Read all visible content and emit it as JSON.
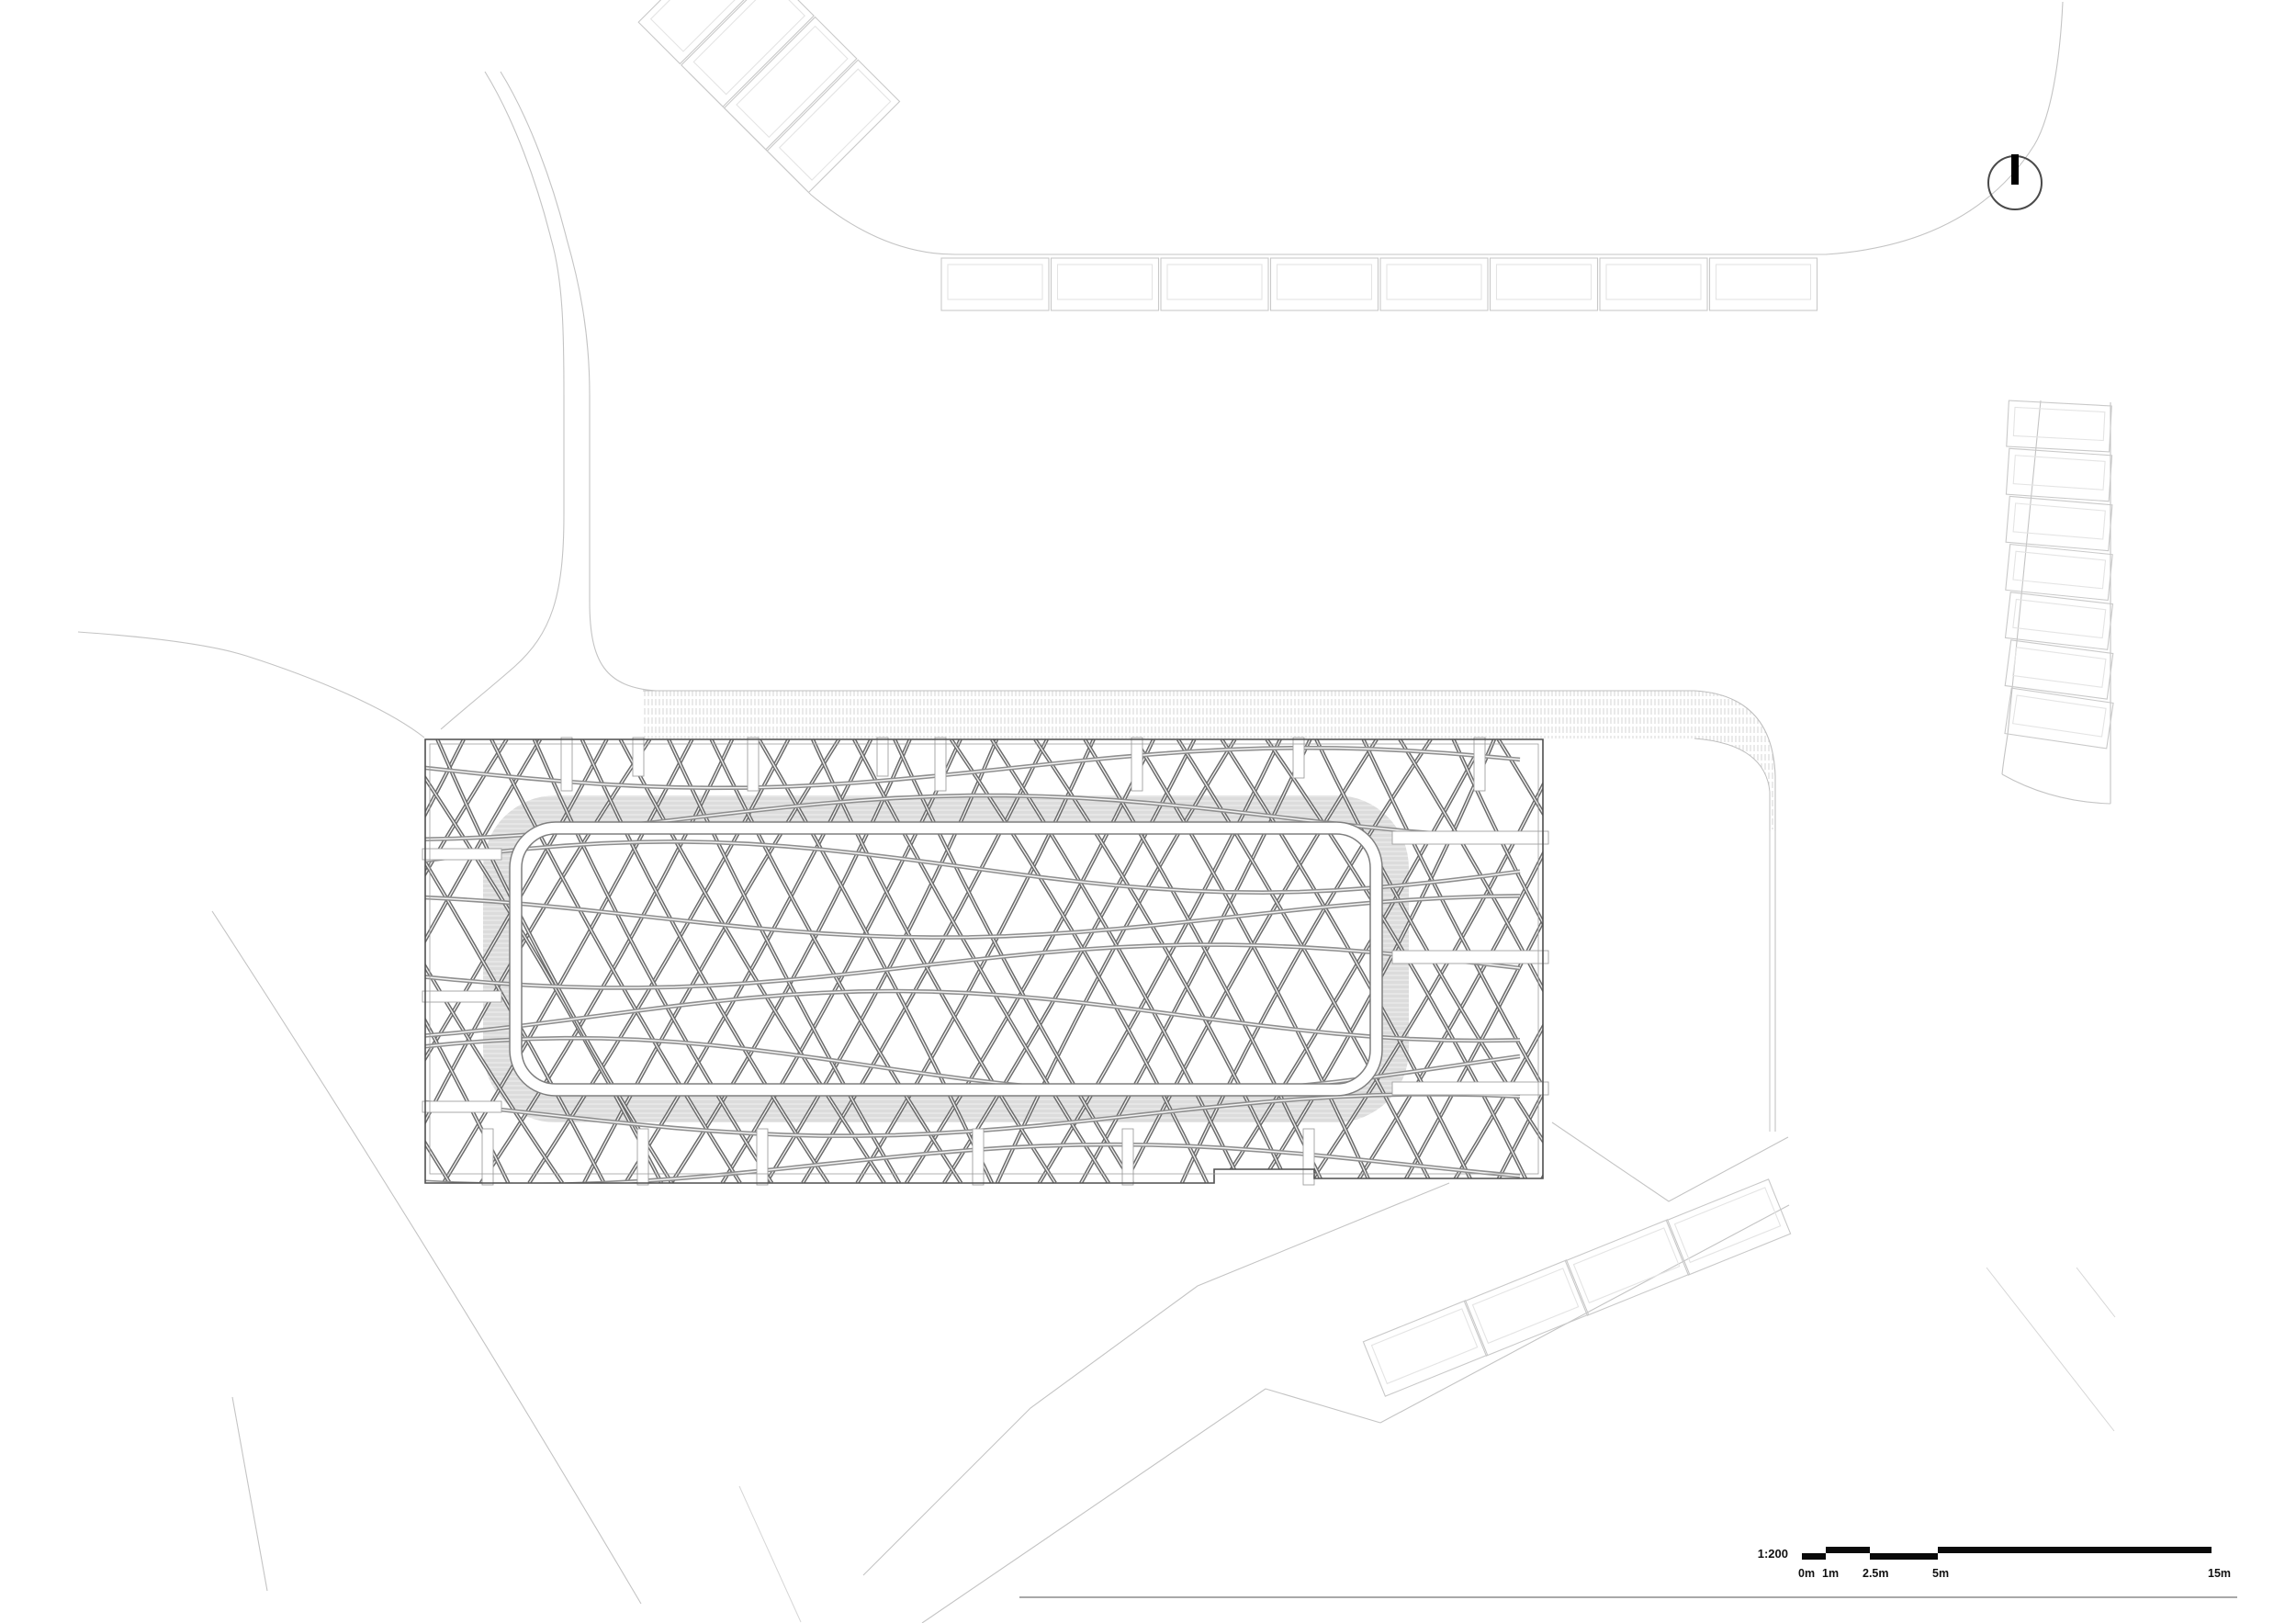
{
  "sheet": {
    "type": "architectural-site-plan",
    "background": "#ffffff"
  },
  "scale_bar": {
    "ratio_label": "1:200",
    "tick_labels": [
      "0m",
      "1m",
      "2.5m",
      "5m",
      "15m"
    ]
  },
  "north_arrow": {
    "symbol": "circle-with-north-bar"
  },
  "parking": {
    "top_row_stall_count": 8,
    "right_column_stall_count": 7,
    "bottom_diagonal_stall_count": 4,
    "upper_left_diagonal_stall_count": 4
  },
  "pavilion": {
    "top_slit_x": [
      617,
      695,
      820,
      961,
      1024,
      1238,
      1414,
      1611
    ],
    "top_slit_len": [
      58,
      42,
      58,
      42,
      58,
      58,
      44,
      58
    ],
    "bottom_slit_x": [
      531,
      700,
      830,
      1065,
      1228,
      1425
    ],
    "left_slit_y": [
      930,
      1085,
      1205
    ],
    "right_aisle_y": [
      912,
      1042,
      1185
    ],
    "steep_line_count": 32,
    "shallow_line_count": 9
  },
  "colors": {
    "road": "#c4c4c4",
    "road_faint": "#d6d6d6",
    "stall_outer": "#c9c9c9",
    "stall_inner": "#e4e4e4",
    "lattice_steep": "#6b6b6b",
    "lattice_shallow": "#8f8f8f",
    "band_gray": "#dcdcdc",
    "hatch_gray": "#d8d8d8",
    "panel_border": "#4f4f4f",
    "panel_border_inner": "#9e9e9e",
    "ring_line": "#7f7f7f",
    "slit_line": "#a0a0a0",
    "compass_line": "#4a4a4a",
    "compass_bar": "#000000",
    "rule_gray": "#a8a8a8",
    "text": "#111111"
  }
}
